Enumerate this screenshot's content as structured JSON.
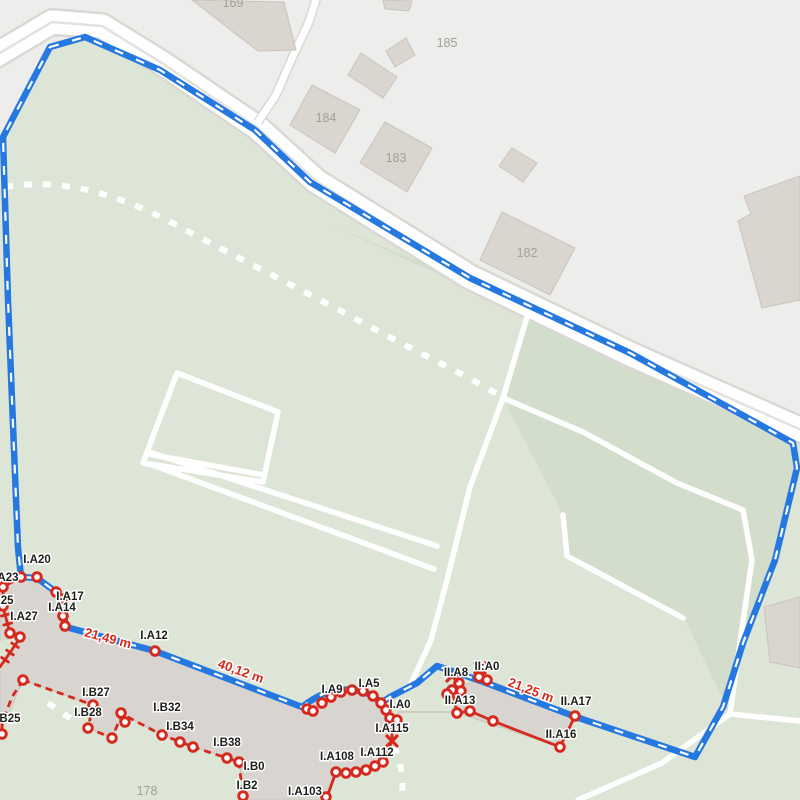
{
  "map": {
    "colors": {
      "base": "#ededeb",
      "green": "#dde5d6",
      "green_dark": "#d2decb",
      "road_casing": "#d9d8d5",
      "road_fill": "#ffffff",
      "road_divider": "#e3e2df",
      "path_white": "#ffffff",
      "building_fill": "#dad5cf",
      "building_stroke": "#c9c4bd",
      "overlay_building_fill": "#d8d4cf",
      "building_label_color": "#a3a099",
      "route_blue": "#2478e0",
      "route_dash": "#ffffff",
      "survey_red": "#d5291e",
      "label_color": "#1d1d1b",
      "label_halo": "#ffffff"
    },
    "terrain": {
      "green": "M3,137 L50,47 L85,37 L160,70 L255,130 L315,181 L470,277 L630,353 L800,429 L800,800 L0,800 L0,137 Z",
      "green_dark": "M330,225 L795,435 L797,468 L775,560 L743,643 L730,714 L684,618 L567,557 L563,515 L503,398 L527,317 L470,287 L420,262 Z",
      "green_notch": "M0,641 L18,638 L0,671 Z"
    },
    "roads": {
      "main": "M-12,60 L52,22 L102,26 L162,63 L258,128 L316,181 L425,249 L470,277 L630,354 L815,436",
      "lane": "M317,-4 L309,22 L293,56 L276,95 L258,122"
    },
    "white_paths": [
      "M177,373 L278,412 L263,482 L143,463 Z",
      "M148,454 L264,475",
      "M149,452 L437,546",
      "M150,464 L434,569",
      "M527,317 L503,398 L470,487 L447,580 L431,640 L410,686",
      "M503,398 L583,432 L677,483 L743,510 L752,560 L741,635 L730,714",
      "M730,714 L800,721",
      "M730,714 L662,763 L578,800",
      "M563,515 L567,556 L683,618"
    ],
    "dotted_paths": [
      "M5,187 C70,176 130,200 180,227 C240,259 310,294 365,324 C405,346 465,374 500,396",
      "M394,746 C400,760 404,776 402,800",
      "M48,703 L76,722"
    ],
    "buildings": [
      "M192,0 L284,2 L296,50 L258,51 Z",
      "M383,0 L412,1 L409,11 L385,9 Z",
      "M386,51 L406,38 L415,55 L395,67 Z",
      "M361,53 L397,77 L383,98 L348,75 Z",
      "M312,85 L360,110 L335,153 L290,125 Z",
      "M385,122 L432,148 L407,192 L360,163 Z",
      "M512,148 L537,163 L523,182 L499,166 Z",
      "M502,212 L575,248 L550,295 L480,260 Z",
      "M800,176 L744,196 L751,214 L738,221 L762,308 L800,300 Z",
      "M764,607 L800,597 L800,668 L770,662 Z"
    ],
    "building_labels": [
      {
        "text": "169",
        "x": 233,
        "y": 3
      },
      {
        "text": "185",
        "x": 447,
        "y": 43
      },
      {
        "text": "184",
        "x": 326,
        "y": 118
      },
      {
        "text": "183",
        "x": 396,
        "y": 158
      },
      {
        "text": "182",
        "x": 527,
        "y": 253
      },
      {
        "text": "178",
        "x": 147,
        "y": 791
      }
    ],
    "overlay_buildings": [
      "M0,586 L21,577 L37,577 L57,592 L63,600 L64,616 L66,627 L155,650 L302,706 C318,693 334,688 352,689 C370,690 384,702 390,716 L398,720 L396,741 L383,762 C371,768 358,773 346,773 L336,772 L327,800 L245,800 L239,762 L227,758 L181,742 L162,735 L122,714 L112,738 L88,728 L93,705 L23,680 L0,735 Z",
      "M456,690 L482,677 L575,716 L560,747 L458,713 Z"
    ],
    "building_connector": "M398,712 L457,712",
    "route": "M50,47 L85,37 L160,70 L255,130 L310,182 L470,278 L630,353 L793,443 L797,468 L775,560 L743,643 L723,707 L695,757 L576,717 L481,681 L437,666 L417,683 L390,697 L381,703 C376,697 366,691 352,690 C335,688 318,694 302,707 L155,651 L66,627 L64,616 L62,600 L56,592 L37,578 L21,577 L18,548 L14,450 L8,300 L3,137 Z",
    "red_solid": [
      "M3,585 L3,607 L10,633 L20,638 L0,667",
      "M18.3,647.5 L11.7,643 M13.3,654.8 L6.7,650.2 M8.3,662 L1.7,657.5 M9.2,614 L1.4,616 M11.6,623 L3.8,625",
      "M3,587 L21,577",
      "M390,719 L398,721 M392,721 L392,741",
      "M392,741 L383,762 C375,766 366,770 356,772 C349,773 341,773 336,772 L327,797 L329,800",
      "M459,683 L452,690 L461,691 M452,690 L457,713 L470,711 L493,721 L560,747 L575,716 M479,677 L487,680"
    ],
    "red_dashed": [
      "M23,680 L93,705 L88,728 L112,738 L122,714 L162,735 L181,742 L193,747 L227,758 L239,762 L243,797",
      "M23,680 L12,697 L2,723 L2,734"
    ],
    "survey_points": [
      [
        3,
        587
      ],
      [
        3,
        606
      ],
      [
        10,
        633
      ],
      [
        20,
        637
      ],
      [
        2,
        734
      ],
      [
        21,
        577
      ],
      [
        37,
        577
      ],
      [
        56,
        592
      ],
      [
        62,
        599
      ],
      [
        63,
        616
      ],
      [
        65,
        626
      ],
      [
        155,
        651
      ],
      [
        23,
        680
      ],
      [
        93,
        705
      ],
      [
        88,
        728
      ],
      [
        112,
        738
      ],
      [
        121,
        713
      ],
      [
        125,
        722
      ],
      [
        162,
        735
      ],
      [
        180,
        742
      ],
      [
        193,
        747
      ],
      [
        227,
        758
      ],
      [
        239,
        762
      ],
      [
        243,
        796
      ],
      [
        307,
        709
      ],
      [
        313,
        711
      ],
      [
        322,
        703
      ],
      [
        331,
        697
      ],
      [
        341,
        692
      ],
      [
        352,
        690
      ],
      [
        363,
        691
      ],
      [
        373,
        696
      ],
      [
        381,
        703
      ],
      [
        386,
        710
      ],
      [
        390,
        718
      ],
      [
        397,
        720
      ],
      [
        383,
        762
      ],
      [
        375,
        766
      ],
      [
        366,
        770
      ],
      [
        356,
        772
      ],
      [
        346,
        773
      ],
      [
        336,
        772
      ],
      [
        326,
        797
      ],
      [
        459,
        683
      ],
      [
        452,
        690
      ],
      [
        461,
        691
      ],
      [
        447,
        694
      ],
      [
        479,
        677
      ],
      [
        487,
        680
      ],
      [
        457,
        713
      ],
      [
        470,
        711
      ],
      [
        493,
        721
      ],
      [
        560,
        747
      ],
      [
        575,
        716
      ]
    ],
    "cross_points": [
      [
        392,
        741
      ],
      [
        452,
        676
      ],
      [
        480,
        668
      ]
    ],
    "point_labels": [
      {
        "text": "I.A20",
        "x": 37,
        "y": 560
      },
      {
        "text": "I.A23",
        "x": -9,
        "y": 578,
        "anchor": "start"
      },
      {
        "text": "I.A17",
        "x": 70,
        "y": 597
      },
      {
        "text": "I.A25",
        "x": -14,
        "y": 601,
        "anchor": "start"
      },
      {
        "text": "I.A14",
        "x": 62,
        "y": 608
      },
      {
        "text": "I.A27",
        "x": 24,
        "y": 617
      },
      {
        "text": "I.A12",
        "x": 154,
        "y": 636
      },
      {
        "text": "I.B27",
        "x": 96,
        "y": 693
      },
      {
        "text": "I.B28",
        "x": 88,
        "y": 713
      },
      {
        "text": "I.B25",
        "x": -7,
        "y": 719,
        "anchor": "start"
      },
      {
        "text": "I.B32",
        "x": 167,
        "y": 708
      },
      {
        "text": "I.B34",
        "x": 180,
        "y": 727
      },
      {
        "text": "I.B38",
        "x": 227,
        "y": 743
      },
      {
        "text": "I.B0",
        "x": 254,
        "y": 767
      },
      {
        "text": "I.B2",
        "x": 247,
        "y": 786
      },
      {
        "text": "I.A9",
        "x": 332,
        "y": 690
      },
      {
        "text": "I.A5",
        "x": 369,
        "y": 684
      },
      {
        "text": "I.A0",
        "x": 400,
        "y": 705
      },
      {
        "text": "I.A115",
        "x": 392,
        "y": 729
      },
      {
        "text": "I.A112",
        "x": 377,
        "y": 753
      },
      {
        "text": "I.A108",
        "x": 337,
        "y": 757
      },
      {
        "text": "I.A103",
        "x": 305,
        "y": 792
      },
      {
        "text": "II.A8",
        "x": 456,
        "y": 673
      },
      {
        "text": "II:A0",
        "x": 487,
        "y": 667
      },
      {
        "text": "II.A13",
        "x": 460,
        "y": 701
      },
      {
        "text": "II.A17",
        "x": 576,
        "y": 702
      },
      {
        "text": "II.A16",
        "x": 561,
        "y": 735
      }
    ],
    "measurements": [
      {
        "text": "21,49 m",
        "x": 108,
        "y": 638,
        "angle": 15
      },
      {
        "text": "40,12 m",
        "x": 241,
        "y": 671,
        "angle": 20
      },
      {
        "text": "21,25 m",
        "x": 531,
        "y": 690,
        "angle": 21
      }
    ]
  }
}
